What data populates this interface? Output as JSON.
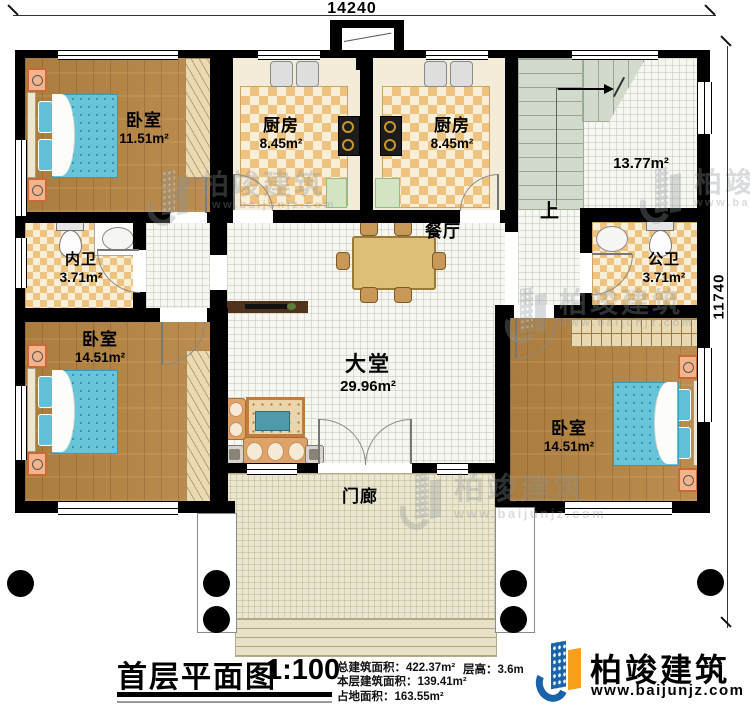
{
  "plan": {
    "dim_top": "14240",
    "dim_right": "11740",
    "stairs_up_label": "上",
    "rooms": [
      {
        "name": "卧室",
        "area": "11.51m²"
      },
      {
        "name": "厨房",
        "area": "8.45m²"
      },
      {
        "name": "厨房",
        "area": "8.45m²"
      },
      {
        "name": "",
        "area": "13.77m²"
      },
      {
        "name": "内卫",
        "area": "3.71m²"
      },
      {
        "name": "公卫",
        "area": "3.71m²"
      },
      {
        "name": "餐厅",
        "area": ""
      },
      {
        "name": "卧室",
        "area": "14.51m²"
      },
      {
        "name": "大堂",
        "area": "29.96m²"
      },
      {
        "name": "卧室",
        "area": "14.51m²"
      },
      {
        "name": "门廊",
        "area": ""
      }
    ]
  },
  "title_block": {
    "title": "首层平面图",
    "scale": "1:100",
    "stats": [
      "总建筑面积：422.37m²",
      "本层建筑面积：139.41m²",
      "占地面积：163.55m²"
    ],
    "floor_height": "层高：3.6m"
  },
  "brand": {
    "name": "柏竣建筑",
    "website": "www.baijunjz.com"
  },
  "watermark": {
    "name": "柏竣建筑",
    "website": "www.baijunjz.com"
  },
  "colors": {
    "wall": "#000000",
    "wood_floor": "#b0823f",
    "brand_blue": "#1a63a8",
    "brand_orange": "#f6a01c",
    "bed_blue": "#68c4d9",
    "checker_tan": "#eec27f"
  }
}
